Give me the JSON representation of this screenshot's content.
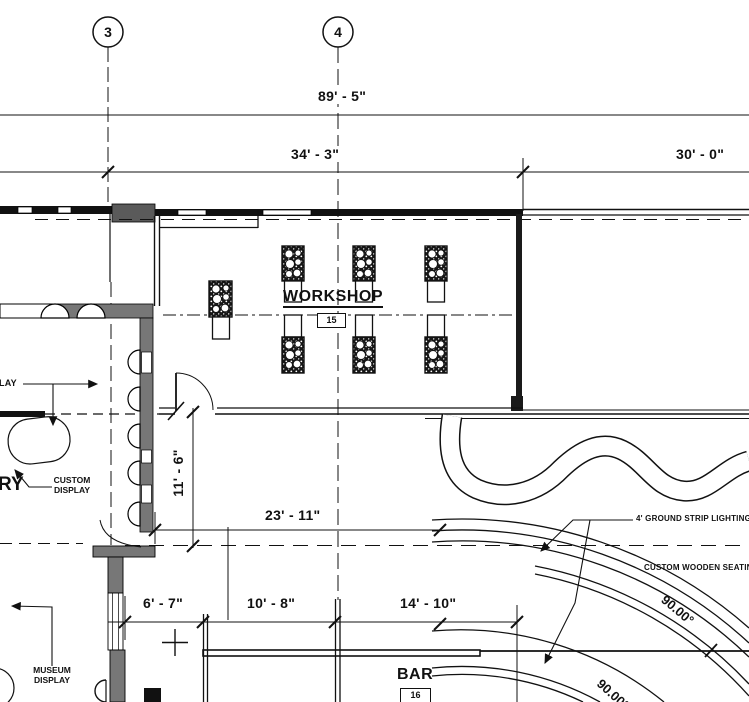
{
  "drawing": {
    "grid_bubbles": {
      "left": "3",
      "right": "4"
    },
    "dimensions": {
      "overall": "89' - 5\"",
      "bay_left": "34' - 3\"",
      "bay_right": "30' - 0\"",
      "workshop_depth": "11' - 6\"",
      "corridor": "23' - 11\"",
      "bar_seg_1": "6' - 7\"",
      "bar_seg_2": "10' - 8\"",
      "bar_seg_3": "14' - 10\""
    },
    "rooms": {
      "workshop": {
        "name": "WORKSHOP",
        "number": "15"
      },
      "bar": {
        "name": "BAR",
        "number": "16"
      },
      "gallery_partial": "RY"
    },
    "annotations": {
      "display_partial": "LAY",
      "custom_display": "CUSTOM\nDISPLAY",
      "museum_display": "MUSEUM\nDISPLAY",
      "ground_strip_lighting": "4' GROUND STRIP LIGHTING",
      "wooden_seating": "CUSTOM WOODEN SEATING",
      "angle_outer": "90.00°",
      "angle_inner": "90.00°"
    }
  }
}
